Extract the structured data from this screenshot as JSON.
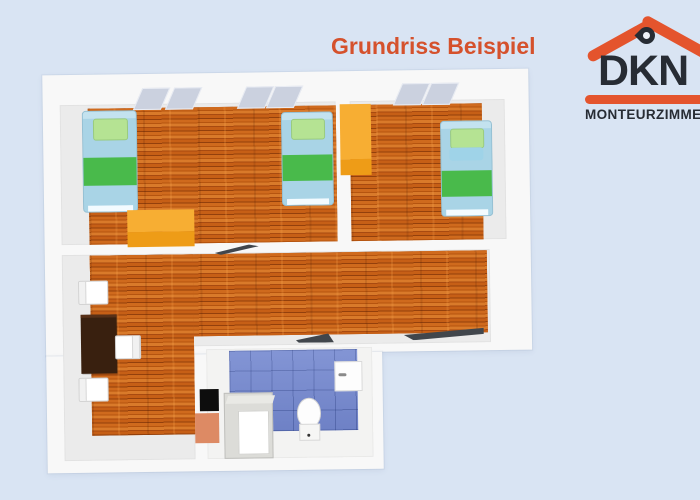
{
  "title": "Grundriss Beispiel",
  "logo": {
    "name": "DKN",
    "tagline": "MONTEURZIMMER",
    "roof_color": "#e4542d",
    "text_color": "#272c34"
  },
  "colors": {
    "background": "#d9e4f3",
    "title_accent": "#d5512c",
    "wall_white": "#f8f8f8",
    "floor_gray": "#ebebeb",
    "wood_floor": "#c05e18",
    "bathroom_tile_blue": "#7589d0",
    "bed_frame_blue": "#a9d4e6",
    "blanket_green": "#49ba4b",
    "pillow_green": "#b5e393",
    "wardrobe_orange": "#f7ae33",
    "table_brown": "#39200f",
    "door_dark": "#41464c",
    "salmon_accent": "#dd8a64"
  },
  "plan": {
    "type": "floorplan-3d-top-view",
    "rooms": [
      "bedroom-left",
      "bedroom-right",
      "living-room",
      "bathroom"
    ],
    "furniture_counts": {
      "beds": 3,
      "wardrobes": 2,
      "tables": 1,
      "chairs": 3,
      "windows": 3,
      "doors": 3
    },
    "bathroom_fixtures": [
      "shower",
      "toilet",
      "sink"
    ]
  }
}
